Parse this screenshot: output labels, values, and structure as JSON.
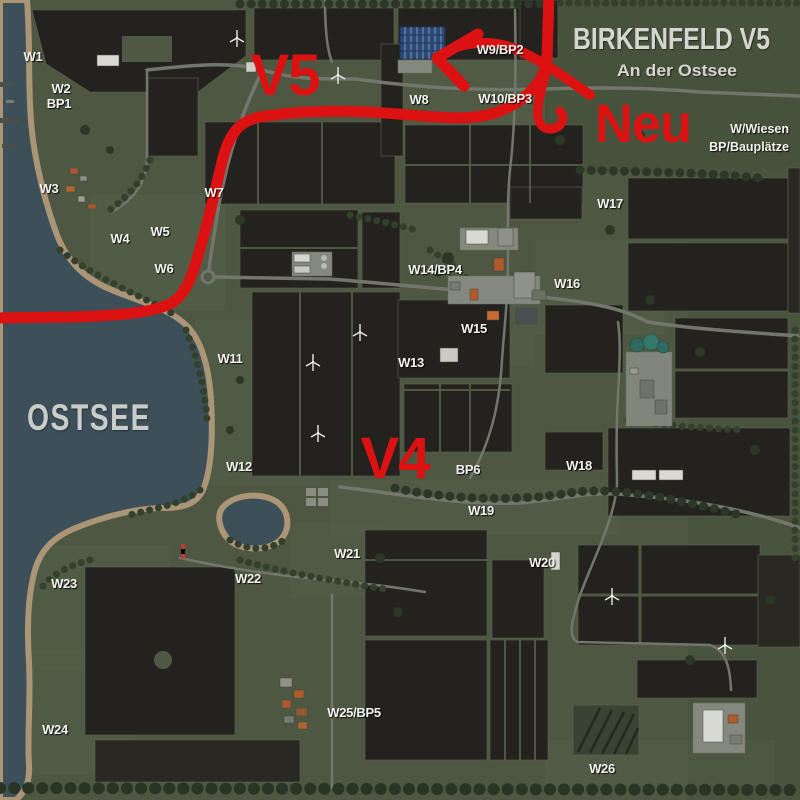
{
  "header": {
    "title": "BIRKENFELD V5",
    "subtitle": "An der Ostsee",
    "legend_line1": "W/Wiesen",
    "legend_line2": "BP/Bauplätze"
  },
  "annotations": {
    "version_new_area": "V5",
    "version_old_area": "V4",
    "new_marker": "Neu",
    "sea_name": "OSTSEE"
  },
  "colors": {
    "annotation_red": "#dc1212",
    "water": "#3d4f59",
    "field_dark": "#24221e",
    "grass": "#4e5843",
    "road": "#73766c",
    "beach": "#ab9577",
    "label_white": "#f2f2ee"
  },
  "field_labels": [
    {
      "text": "W1",
      "x": 33,
      "y": 61
    },
    {
      "text": "W2",
      "x": 61,
      "y": 93
    },
    {
      "text": "BP1",
      "x": 59,
      "y": 108
    },
    {
      "text": "W3",
      "x": 49,
      "y": 193
    },
    {
      "text": "W7",
      "x": 214,
      "y": 197
    },
    {
      "text": "W5",
      "x": 160,
      "y": 236
    },
    {
      "text": "W4",
      "x": 120,
      "y": 243
    },
    {
      "text": "W6",
      "x": 164,
      "y": 273
    },
    {
      "text": "W8",
      "x": 419,
      "y": 104
    },
    {
      "text": "W9/BP2",
      "x": 500,
      "y": 54
    },
    {
      "text": "W10/BP3",
      "x": 505,
      "y": 103
    },
    {
      "text": "W17",
      "x": 610,
      "y": 208
    },
    {
      "text": "W14/BP4",
      "x": 435,
      "y": 274
    },
    {
      "text": "W16",
      "x": 567,
      "y": 288
    },
    {
      "text": "W15",
      "x": 474,
      "y": 333
    },
    {
      "text": "W11",
      "x": 230,
      "y": 363
    },
    {
      "text": "W13",
      "x": 411,
      "y": 367
    },
    {
      "text": "W12",
      "x": 239,
      "y": 471
    },
    {
      "text": "BP6",
      "x": 468,
      "y": 474
    },
    {
      "text": "W18",
      "x": 579,
      "y": 470
    },
    {
      "text": "W19",
      "x": 481,
      "y": 515
    },
    {
      "text": "W21",
      "x": 347,
      "y": 558
    },
    {
      "text": "W20",
      "x": 542,
      "y": 567
    },
    {
      "text": "W22",
      "x": 248,
      "y": 583
    },
    {
      "text": "W23",
      "x": 64,
      "y": 588
    },
    {
      "text": "W24",
      "x": 55,
      "y": 734
    },
    {
      "text": "W25/BP5",
      "x": 354,
      "y": 717
    },
    {
      "text": "W26",
      "x": 602,
      "y": 773
    }
  ]
}
